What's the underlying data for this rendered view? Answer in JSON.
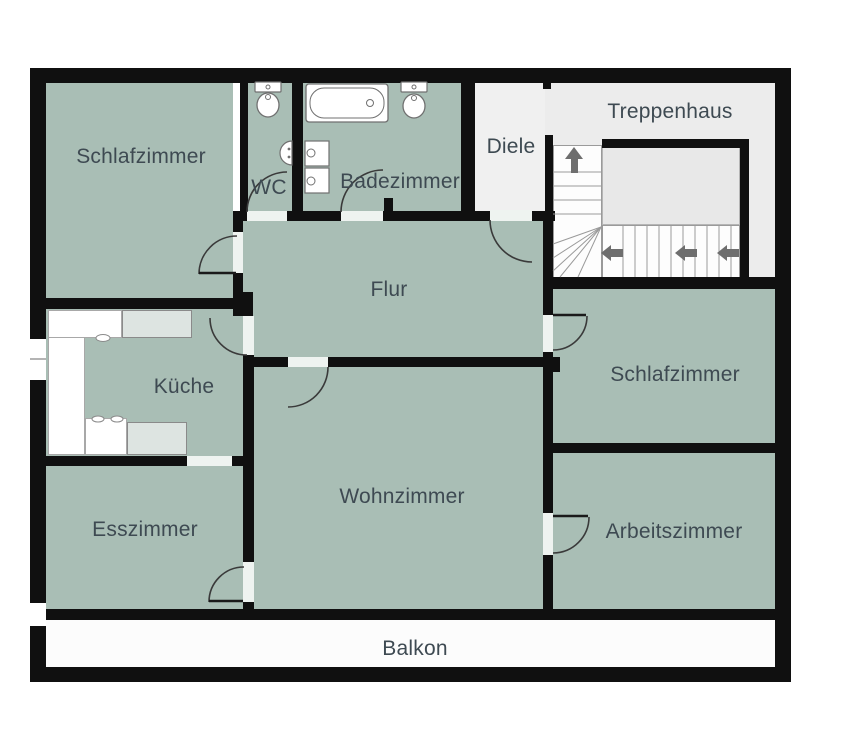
{
  "title": "Grundriss / floor plan",
  "colors": {
    "wall": "#101010",
    "room": "#a9beb5",
    "stairwell": "#ececec",
    "hall_entry": "#f0f0f0",
    "landing": "#e8e8e8",
    "balcony": "#fcfcfc",
    "door_gap": "#eef3f0",
    "white": "#ffffff",
    "appliance": "#dde4e1",
    "fixture_stroke": "#707070",
    "tread": "#9a9a9a",
    "arc": "#3a3a3a",
    "arrow": "#6e6e6e",
    "label_text": "#3e4a52"
  },
  "rooms": [
    {
      "id": "schlafzimmer-tl",
      "label": "Schlafzimmer",
      "x": 46,
      "y": 83,
      "w": 187,
      "h": 215,
      "fill": "#a9beb5",
      "lx": 141,
      "ly": 157
    },
    {
      "id": "wc",
      "label": "WC",
      "x": 248,
      "y": 83,
      "w": 44,
      "h": 130,
      "fill": "#a9beb5",
      "lx": 269,
      "ly": 188
    },
    {
      "id": "badezimmer",
      "label": "Badezimmer",
      "x": 303,
      "y": 83,
      "w": 158,
      "h": 130,
      "fill": "#a9beb5",
      "lx": 400,
      "ly": 182
    },
    {
      "id": "diele",
      "label": "Diele",
      "x": 475,
      "y": 83,
      "w": 70,
      "h": 128,
      "fill": "#f0f0f0",
      "lx": 511,
      "ly": 147
    },
    {
      "id": "treppenhaus",
      "label": "Treppenhaus",
      "x": 545,
      "y": 83,
      "w": 230,
      "h": 195,
      "fill": "#ececec",
      "lx": 670,
      "ly": 112
    },
    {
      "id": "flur",
      "label": "Flur",
      "x": 243,
      "y": 218,
      "w": 300,
      "h": 140,
      "fill": "#a9beb5",
      "lx": 389,
      "ly": 290
    },
    {
      "id": "kueche",
      "label": "Küche",
      "x": 46,
      "y": 307,
      "w": 197,
      "h": 150,
      "fill": "#a9beb5",
      "lx": 184,
      "ly": 387
    },
    {
      "id": "wohnzimmer",
      "label": "Wohnzimmer",
      "x": 253,
      "y": 365,
      "w": 290,
      "h": 245,
      "fill": "#a9beb5",
      "lx": 402,
      "ly": 497
    },
    {
      "id": "esszimmer",
      "label": "Esszimmer",
      "x": 46,
      "y": 464,
      "w": 197,
      "h": 146,
      "fill": "#a9beb5",
      "lx": 145,
      "ly": 530
    },
    {
      "id": "schlafzimmer-r",
      "label": "Schlafzimmer",
      "x": 553,
      "y": 289,
      "w": 222,
      "h": 155,
      "fill": "#a9beb5",
      "lx": 675,
      "ly": 375
    },
    {
      "id": "arbeitszimmer",
      "label": "Arbeitszimmer",
      "x": 553,
      "y": 452,
      "w": 222,
      "h": 158,
      "fill": "#a9beb5",
      "lx": 674,
      "ly": 532
    },
    {
      "id": "balkon",
      "label": "Balkon",
      "x": 46,
      "y": 620,
      "w": 729,
      "h": 47,
      "fill": "#fcfcfc",
      "lx": 415,
      "ly": 649
    }
  ],
  "stairs": [
    {
      "id": "stair-landing",
      "x": 602,
      "y": 146,
      "w": 138,
      "h": 79,
      "fill": "#e8e8e8",
      "border": "#b5b5b5"
    },
    {
      "id": "stair-flight-up",
      "x": 553,
      "y": 145,
      "w": 49,
      "h": 133,
      "fill": "#fdfdfd",
      "border": "#9a9a9a"
    },
    {
      "id": "stair-flight-lower",
      "x": 602,
      "y": 225,
      "w": 138,
      "h": 53,
      "fill": "#fdfdfd",
      "border": "#9a9a9a"
    }
  ],
  "counter": [
    {
      "id": "kitchen-counter-left",
      "x": 48,
      "y": 310,
      "w": 37,
      "h": 145,
      "fill": "#ffffff",
      "border": "#a8a8a8"
    },
    {
      "id": "kitchen-counter-top",
      "x": 48,
      "y": 310,
      "w": 74,
      "h": 28,
      "fill": "#ffffff",
      "border": "#a8a8a8"
    },
    {
      "id": "kitchen-appliance-top",
      "x": 122,
      "y": 310,
      "w": 70,
      "h": 28,
      "fill": "#dde4e1",
      "border": "#8a8a8a"
    },
    {
      "id": "kitchen-counter-bottom",
      "x": 85,
      "y": 418,
      "w": 42,
      "h": 37,
      "fill": "#ffffff",
      "border": "#a8a8a8"
    },
    {
      "id": "kitchen-appliance-bottom",
      "x": 127,
      "y": 422,
      "w": 60,
      "h": 33,
      "fill": "#dde4e1",
      "border": "#8a8a8a"
    }
  ],
  "walls": [
    {
      "id": "wall-outer-top",
      "x": 30,
      "y": 68,
      "w": 761,
      "h": 15
    },
    {
      "id": "wall-outer-left",
      "x": 30,
      "y": 68,
      "w": 16,
      "h": 614
    },
    {
      "id": "wall-outer-right",
      "x": 775,
      "y": 68,
      "w": 16,
      "h": 614
    },
    {
      "id": "wall-outer-bottom",
      "x": 30,
      "y": 667,
      "w": 761,
      "h": 15
    },
    {
      "id": "wall-schlafzimmer-wc",
      "x": 240,
      "y": 83,
      "w": 8,
      "h": 130
    },
    {
      "id": "wall-wc-bad",
      "x": 292,
      "y": 83,
      "w": 11,
      "h": 130
    },
    {
      "id": "wall-bad-diele",
      "x": 461,
      "y": 83,
      "w": 14,
      "h": 128
    },
    {
      "id": "wall-diele-treppenhaus",
      "x": 545,
      "y": 135,
      "w": 8,
      "h": 147
    },
    {
      "id": "wall-stub-treppenhaus-top",
      "x": 543,
      "y": 83,
      "w": 8,
      "h": 6
    },
    {
      "id": "wall-flur-top",
      "x": 233,
      "y": 211,
      "w": 322,
      "h": 10
    },
    {
      "id": "wall-stub-bad",
      "x": 384,
      "y": 198,
      "w": 9,
      "h": 13
    },
    {
      "id": "wall-landing-top",
      "x": 602,
      "y": 139,
      "w": 146,
      "h": 9
    },
    {
      "id": "wall-landing-right",
      "x": 740,
      "y": 139,
      "w": 9,
      "h": 150
    },
    {
      "id": "wall-treppenhaus-bottom",
      "x": 545,
      "y": 277,
      "w": 230,
      "h": 12
    },
    {
      "id": "wall-schlafzimmer-flur",
      "x": 233,
      "y": 211,
      "w": 10,
      "h": 89
    },
    {
      "id": "wall-schlafzimmer-kueche",
      "x": 30,
      "y": 298,
      "w": 203,
      "h": 11
    },
    {
      "id": "wall-corner-block",
      "x": 233,
      "y": 292,
      "w": 20,
      "h": 24
    },
    {
      "id": "wall-kueche-wohnzimmer",
      "x": 243,
      "y": 355,
      "w": 11,
      "h": 255
    },
    {
      "id": "wall-flur-wohnzimmer",
      "x": 243,
      "y": 357,
      "w": 310,
      "h": 10
    },
    {
      "id": "wall-flur-schlafzimmer-r",
      "x": 543,
      "y": 211,
      "w": 10,
      "h": 156
    },
    {
      "id": "wall-stub-schlafzimmer-r",
      "x": 553,
      "y": 357,
      "w": 7,
      "h": 15
    },
    {
      "id": "wall-kueche-esszimmer",
      "x": 30,
      "y": 456,
      "w": 213,
      "h": 10
    },
    {
      "id": "wall-schlafzimmer-arbeitszimmer",
      "x": 553,
      "y": 443,
      "w": 222,
      "h": 10
    },
    {
      "id": "wall-wohnzimmer-arbeitszimmer",
      "x": 543,
      "y": 367,
      "w": 10,
      "h": 242
    },
    {
      "id": "wall-main-bottom",
      "x": 46,
      "y": 609,
      "w": 729,
      "h": 11
    }
  ],
  "door_gaps": [
    {
      "id": "gap-wc-door",
      "x": 247,
      "y": 211,
      "w": 40,
      "h": 10,
      "fill": "#eef3f0"
    },
    {
      "id": "gap-bad-door",
      "x": 341,
      "y": 211,
      "w": 42,
      "h": 10,
      "fill": "#eef3f0"
    },
    {
      "id": "gap-diele-door",
      "x": 490,
      "y": 210,
      "w": 42,
      "h": 11,
      "fill": "#eef3f0"
    },
    {
      "id": "gap-schlafzimmer-tl-door",
      "x": 233,
      "y": 232,
      "w": 10,
      "h": 41,
      "fill": "#eef3f0"
    },
    {
      "id": "gap-kueche-door",
      "x": 243,
      "y": 316,
      "w": 11,
      "h": 39,
      "fill": "#eef3f0"
    },
    {
      "id": "gap-flur-wohnzimmer-door",
      "x": 288,
      "y": 357,
      "w": 40,
      "h": 10,
      "fill": "#eef3f0"
    },
    {
      "id": "gap-schlafzimmer-r-door",
      "x": 543,
      "y": 315,
      "w": 10,
      "h": 37,
      "fill": "#eef3f0"
    },
    {
      "id": "gap-esszimmer-door",
      "x": 243,
      "y": 562,
      "w": 11,
      "h": 40,
      "fill": "#eef3f0"
    },
    {
      "id": "gap-arbeitszimmer-door",
      "x": 543,
      "y": 513,
      "w": 10,
      "h": 42,
      "fill": "#eef3f0"
    },
    {
      "id": "gap-kueche-esszimmer",
      "x": 187,
      "y": 456,
      "w": 45,
      "h": 10,
      "fill": "#eef3f0"
    },
    {
      "id": "gap-kueche-window",
      "x": 30,
      "y": 339,
      "w": 16,
      "h": 41,
      "fill": "#ffffff"
    },
    {
      "id": "gap-balkon-left",
      "x": 30,
      "y": 603,
      "w": 16,
      "h": 23,
      "fill": "#ffffff"
    }
  ],
  "door_arcs": [
    {
      "id": "arc-schlafzimmer-tl-door",
      "d": "M199,274 A38,38 0 0 1 237,236"
    },
    {
      "id": "arc-wc-door",
      "d": "M247,212 A40,40 0 0 1 287,172"
    },
    {
      "id": "arc-bad-door",
      "d": "M341,212 A42,42 0 0 1 383,170"
    },
    {
      "id": "arc-diele-door",
      "d": "M490,220 A42,42 0 0 0 532,262"
    },
    {
      "id": "arc-flur-wohnzimmer-door",
      "d": "M328,367 A40,40 0 0 1 288,407"
    },
    {
      "id": "arc-kueche-door",
      "d": "M210,318 A37,37 0 0 0 247,355"
    },
    {
      "id": "arc-schlafzimmer-r-door",
      "d": "M587,316 A34,34 0 0 1 553,350"
    },
    {
      "id": "arc-esszimmer-door",
      "d": "M209,602 A35,35 0 0 1 244,567"
    },
    {
      "id": "arc-arbeitszimmer-door",
      "d": "M589,517 A36,36 0 0 1 553,553"
    }
  ],
  "door_leaves": [
    {
      "id": "leaf-schlafzimmer-tl-door",
      "x1": 199,
      "y1": 273,
      "x2": 236,
      "y2": 273
    },
    {
      "id": "leaf-schlafzimmer-r-door",
      "x1": 553,
      "y1": 315,
      "x2": 586,
      "y2": 315
    },
    {
      "id": "leaf-esszimmer-door",
      "x1": 209,
      "y1": 601,
      "x2": 243,
      "y2": 601
    },
    {
      "id": "leaf-arbeitszimmer-door",
      "x1": 553,
      "y1": 516,
      "x2": 588,
      "y2": 516
    }
  ],
  "stair_lines": {
    "treads_vertical_y": [
      172,
      186,
      200,
      214
    ],
    "treads_vertical_x": [
      553,
      602
    ],
    "winders": [
      {
        "x1": 601,
        "y1": 227,
        "x2": 553,
        "y2": 244
      },
      {
        "x1": 601,
        "y1": 227,
        "x2": 553,
        "y2": 258
      },
      {
        "x1": 601,
        "y1": 227,
        "x2": 553,
        "y2": 271
      },
      {
        "x1": 601,
        "y1": 227,
        "x2": 560,
        "y2": 277
      },
      {
        "x1": 601,
        "y1": 227,
        "x2": 578,
        "y2": 277
      }
    ],
    "treads_horizontal_x": [
      623,
      635,
      647,
      659,
      671,
      683,
      695,
      707,
      719,
      731
    ],
    "treads_horizontal_y": [
      225,
      277
    ]
  },
  "arrows": [
    {
      "id": "stairs-up-arrow",
      "dir": "up",
      "x": 565,
      "y": 147
    },
    {
      "id": "stairs-left-arrow-1",
      "dir": "left",
      "x": 601,
      "y": 245
    },
    {
      "id": "stairs-left-arrow-2",
      "dir": "left",
      "x": 675,
      "y": 245
    },
    {
      "id": "stairs-left-arrow-3",
      "dir": "left",
      "x": 717,
      "y": 245
    }
  ],
  "fixtures": {
    "wc_toilet": {
      "cistern": [
        255,
        82,
        26,
        10
      ],
      "cistern_dot": [
        268,
        87,
        2
      ],
      "bowl": [
        268,
        105,
        11,
        12
      ],
      "bowl_dot": [
        268,
        97,
        2.5
      ]
    },
    "bad_toilet": {
      "cistern": [
        401,
        82,
        26,
        10
      ],
      "cistern_dot": [
        414,
        87,
        2
      ],
      "bowl": [
        414,
        106,
        11,
        12
      ],
      "bowl_dot": [
        414,
        98,
        2.5
      ]
    },
    "bathtub": {
      "outer": [
        306,
        84,
        82,
        38
      ],
      "inner": [
        310,
        88,
        74,
        30
      ],
      "drain": [
        370,
        103,
        3.5
      ]
    },
    "bad_sink_1": {
      "rect": [
        305,
        141,
        24,
        25
      ],
      "tap": [
        311,
        153,
        4
      ]
    },
    "bad_sink_2": {
      "rect": [
        305,
        168,
        24,
        25
      ],
      "tap": [
        311,
        181,
        4
      ]
    },
    "wc_sink": {
      "path": "M292,141 A12,12 0 0 0 292,165 Z",
      "dots": [
        [
          289,
          149
        ],
        [
          289,
          157
        ]
      ]
    },
    "kitchen_taps": [
      [
        103,
        338,
        7,
        3.5
      ],
      [
        98,
        419,
        6,
        3
      ],
      [
        117,
        419,
        6,
        3
      ]
    ],
    "window_mullion": {
      "x1": 30,
      "y1": 359,
      "x2": 46,
      "y2": 359
    }
  }
}
